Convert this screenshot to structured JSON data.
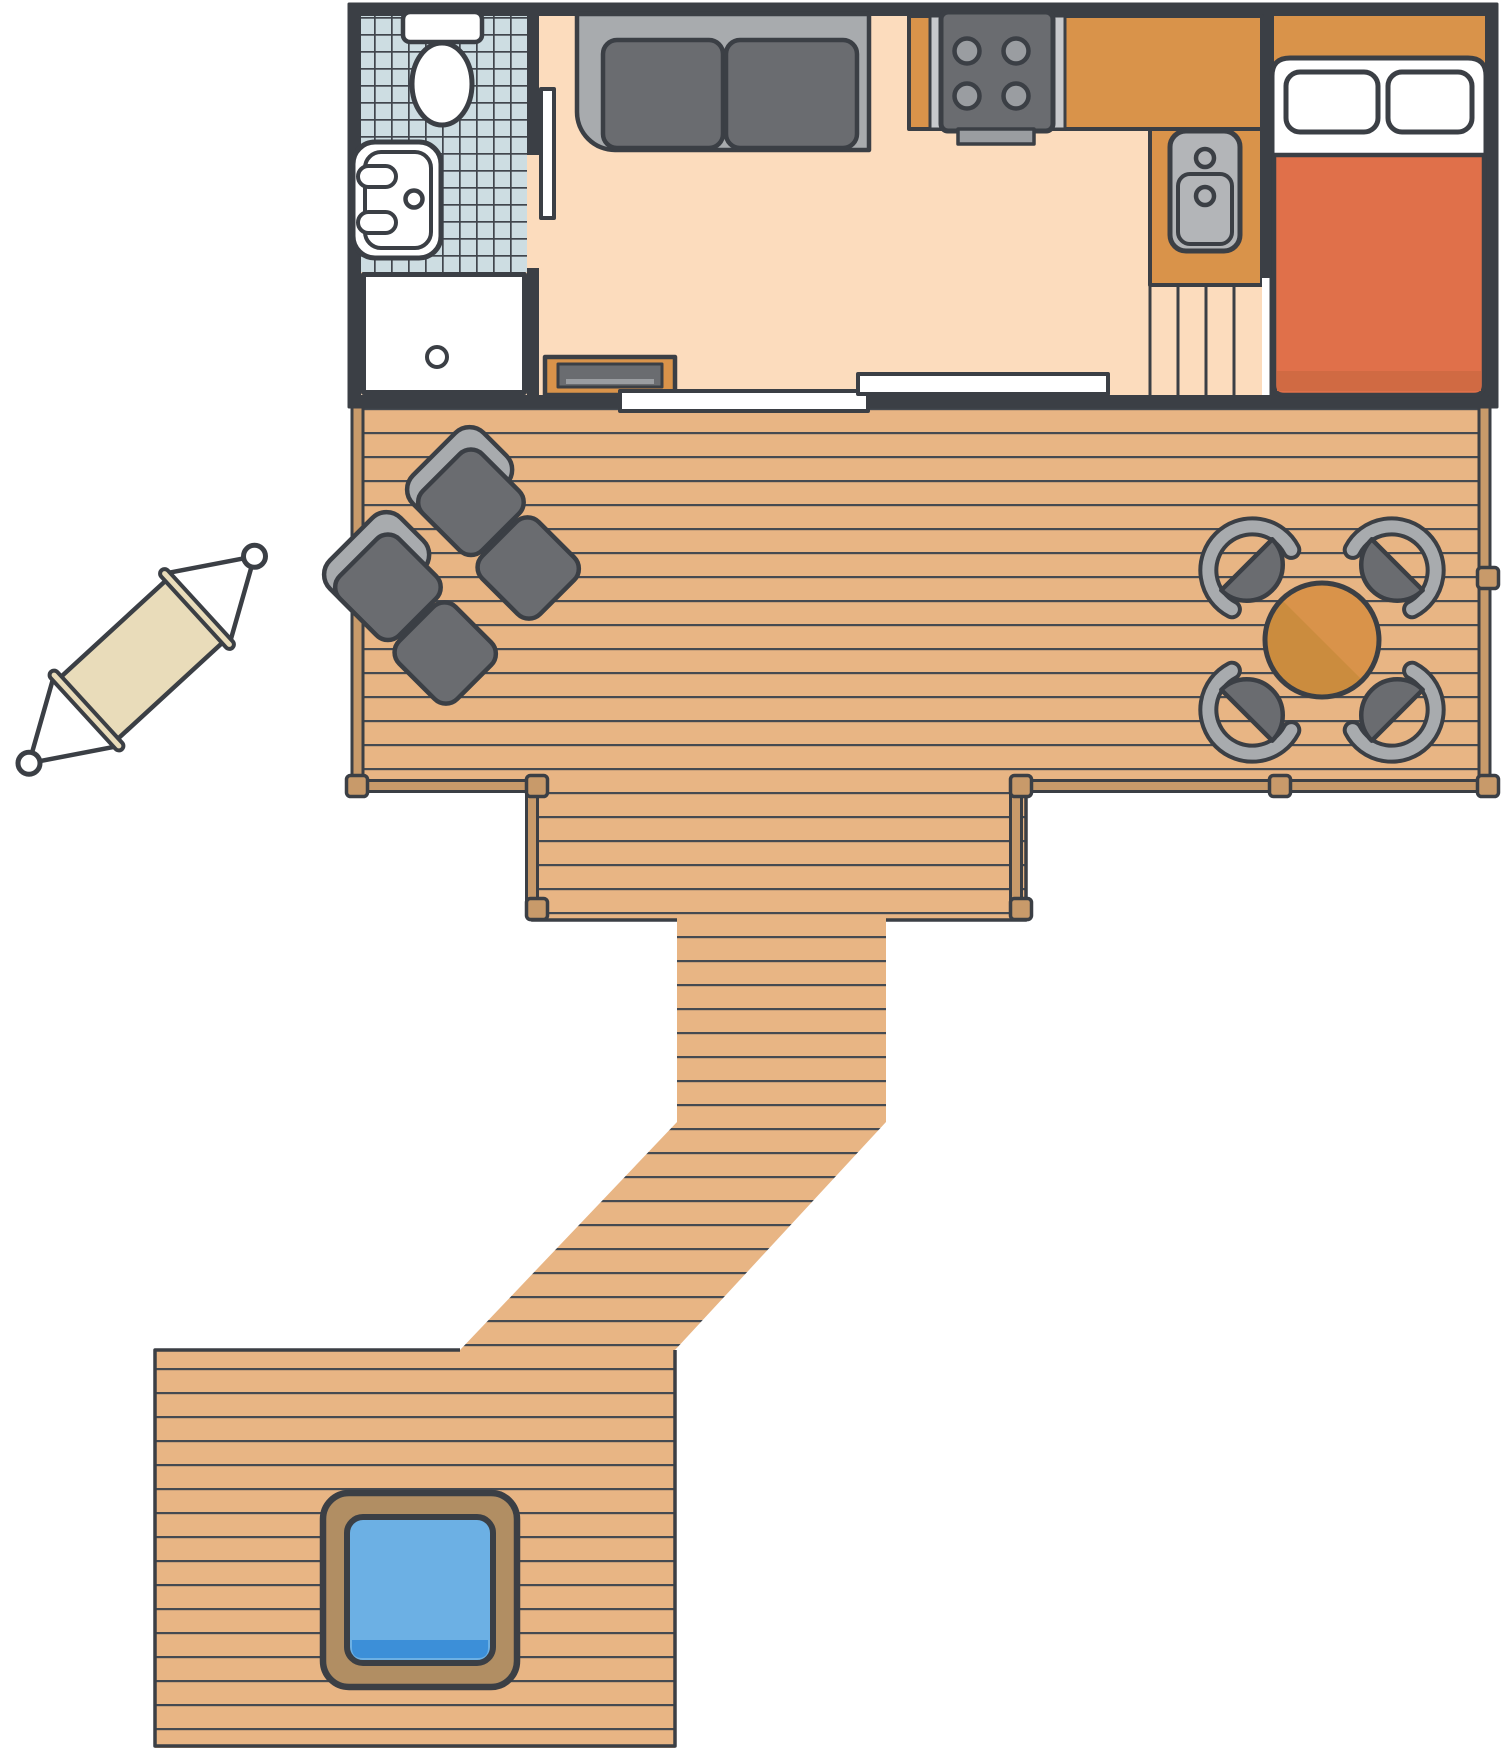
{
  "title": "Cabin with deck, walkway and hot tub — top-down floor plan",
  "type": "floor-plan",
  "colors": {
    "outline": "#3b3f45",
    "floor_peach": "#fcdcbd",
    "tile_blue": "#cddde2",
    "tile_line": "#41464d",
    "white": "#ffffff",
    "counter_orange": "#d9934a",
    "dark_gray": "#6a6c70",
    "light_gray": "#a8abae",
    "mid_gray": "#9a9da1",
    "strip_gray": "#c7c9cc",
    "sink_gray": "#b3b5b8",
    "blanket_orange": "#e0704a",
    "blanket_shadow": "#d06a43",
    "deck_tan": "#e8b584",
    "plank_line": "#454a51",
    "post_brown": "#c89a6a",
    "tub_frame": "#b18e63",
    "water_blue": "#6cb0e4",
    "water_deep": "#3c8fd8",
    "hammock_fabric": "#e9dcba",
    "table_orange": "#d9934a",
    "table_shade": "#cb8c3e"
  },
  "areas": {
    "cabin": {
      "rooms": [
        "bathroom",
        "living-room",
        "kitchen",
        "bedroom"
      ]
    },
    "bathroom": {
      "fixtures": [
        "toilet",
        "sink",
        "shower"
      ],
      "floor": "blue-tile"
    },
    "living_room": {
      "furniture": [
        "sofa",
        "media-cabinet",
        "sliding-door"
      ],
      "floor": "peach"
    },
    "kitchen": {
      "fixtures": [
        "four-burner-stove",
        "sink",
        "l-shaped-counter",
        "steps"
      ]
    },
    "bedroom": {
      "furniture": [
        "double-bed-with-two-pillows"
      ],
      "floor": "orange"
    },
    "main_deck": {
      "furniture": [
        "lounge-chair",
        "lounge-chair",
        "round-dining-table",
        "four-chairs"
      ],
      "railing_posts": 9
    },
    "outside": {
      "furniture": [
        "hammock"
      ]
    },
    "walkway": {
      "shape": "vertical-then-diagonal-boardwalk"
    },
    "lower_deck": {
      "furniture": [
        "square-hot-tub"
      ]
    }
  }
}
